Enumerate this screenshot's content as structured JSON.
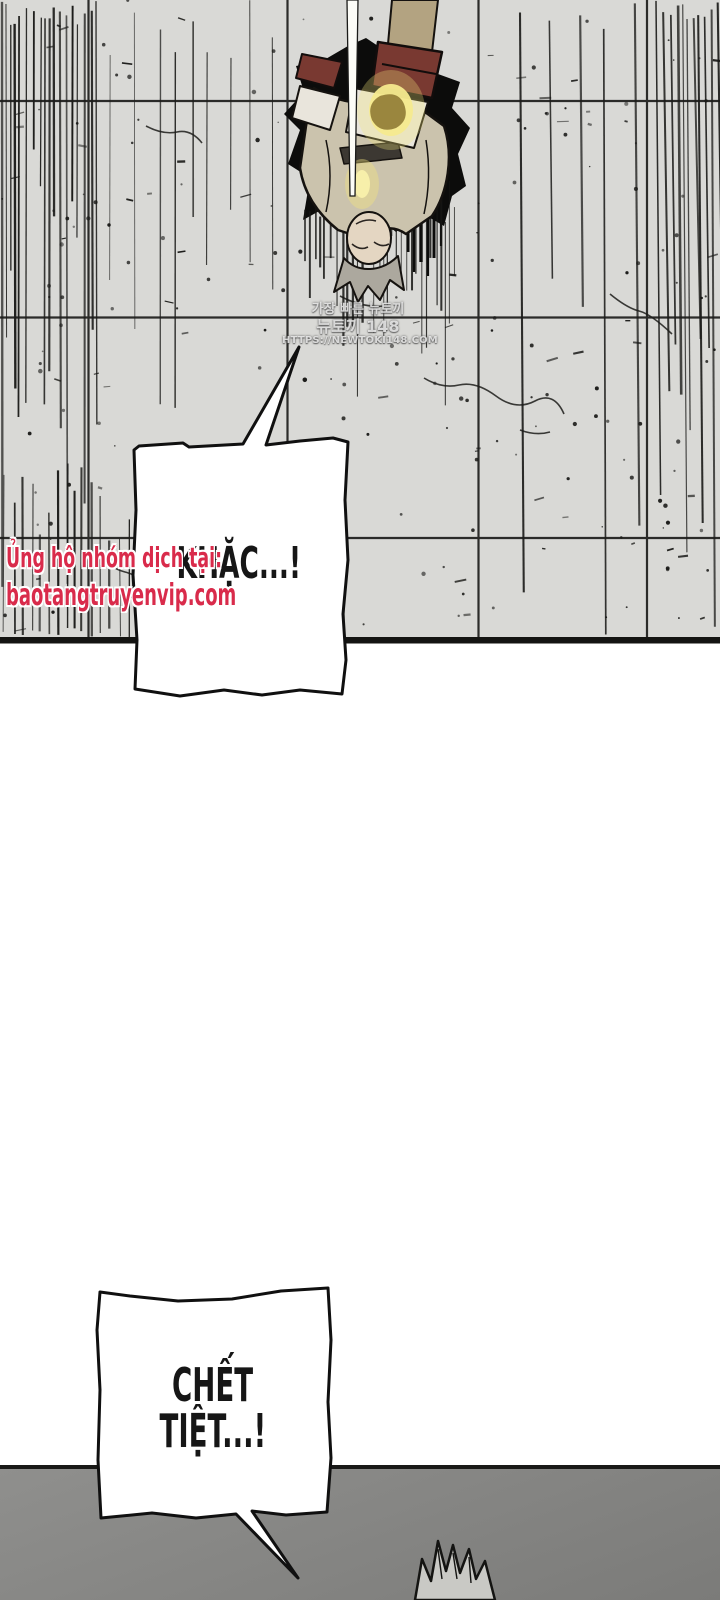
{
  "colors": {
    "wall": "#d9d9d6",
    "floor_top": "#8f8f8d",
    "floor_bottom": "#7b7b79",
    "ink": "#1a1a18",
    "bubble_fill": "#ffffff",
    "credit_red": "#d92b4b",
    "glow_yellow": "#f2e37c",
    "robe_tan": "#cbc3ad",
    "bracer_red": "#793931",
    "sleeve_khaki": "#b3a381",
    "hair_gray": "#aca89e",
    "skin": "#e4d6c2"
  },
  "wall_panel": {
    "watermark": {
      "line1": "가장 빠른 뉴토끼",
      "line2": "뉴토끼 148",
      "line3": "HTTPS://NEWTOKI148.COM"
    },
    "speech_bubble": {
      "text": "KHẶC...!"
    },
    "translator_credit": {
      "line1": "Ủng hộ nhóm dịch tại:",
      "line2": "baotangtruyenvip.com"
    }
  },
  "floor_panel": {
    "speech_bubble": {
      "line1": "CHẾT",
      "line2": "TIỆT...!"
    }
  }
}
